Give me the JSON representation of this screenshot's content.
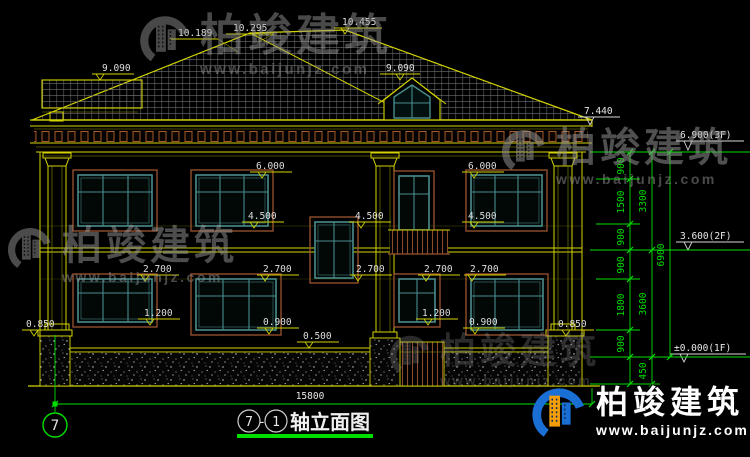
{
  "drawing": {
    "title": {
      "axis_start": "7",
      "separator": "-",
      "axis_end": "1",
      "name": "轴立面图"
    },
    "axis_bubble": "7",
    "overall_width_dim": "15800",
    "elevation_marks": {
      "roof_left": "9.090",
      "ridge_a": "10.189",
      "ridge_b": "10.295",
      "ridge_c": "10.455",
      "dormer": "9.090",
      "eave": "7.440",
      "floor3": "6.900(3F)",
      "floor2": "3.600(2F)",
      "floor1": "±0.000(1F)",
      "win_top_2f_left": "6.000",
      "win_top_2f_right": "6.000",
      "sill_2f_left": "4.500",
      "stair_win_top": "4.500",
      "sill_2f_right": "4.500",
      "win_top_1f_a": "2.700",
      "win_top_1f_b": "2.700",
      "stair_win_bottom": "2.700",
      "win_top_1f_c": "2.700",
      "win_top_1f_d": "2.700",
      "sill_1f_left": "1.200",
      "sill_1f_right_small": "1.200",
      "sill_1f_mid": "0.900",
      "sill_1f_right": "0.900",
      "pedestal_left": "0.850",
      "pedestal_right": "0.850",
      "base_course": "0.500"
    },
    "dim_chain": {
      "seg_900_a": "900",
      "seg_1500": "1500",
      "seg_900_b": "900",
      "seg_900_c": "900",
      "seg_1800": "1800",
      "seg_900_d": "900",
      "seg_450": "450",
      "total_3300": "3300",
      "total_3600": "3600",
      "total_6900": "6900"
    }
  },
  "watermark": {
    "name": "柏竣建筑",
    "url": "www.baijunjz.com"
  },
  "brand": {
    "name": "柏竣建筑",
    "url": "www.baijunjz.com"
  },
  "colors": {
    "background": "#000000",
    "line_yellow": "#d4d400",
    "dim_green": "#00df00",
    "window_teal": "#4a8c8c",
    "trim_brown": "#9c5530",
    "text_white": "#e8e8e8",
    "brand_blue": "#1a6fd4",
    "brand_orange": "#f59e0b"
  }
}
